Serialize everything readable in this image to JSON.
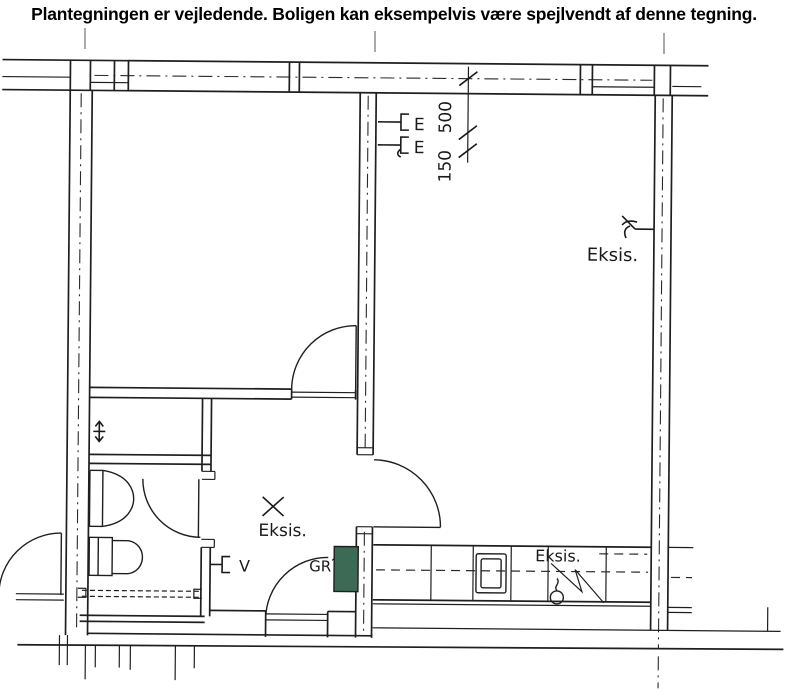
{
  "header": {
    "disclaimer": "Plantegningen er vejledende. Boligen kan eksempelvis være spejlvendt af denne tegning."
  },
  "floor_plan": {
    "labels": {
      "outlet_1": "E",
      "outlet_2": "E",
      "dim_upper": "500",
      "dim_lower": "150",
      "eksis_right": "Eksis.",
      "eksis_hall": "Eksis.",
      "eksis_kitchen": "Eksis.",
      "ventil": "V",
      "gr": "GR"
    },
    "colors": {
      "line": "#1f1f1f",
      "green_marker": "#3d6a55",
      "paper": "#ffffff"
    }
  }
}
